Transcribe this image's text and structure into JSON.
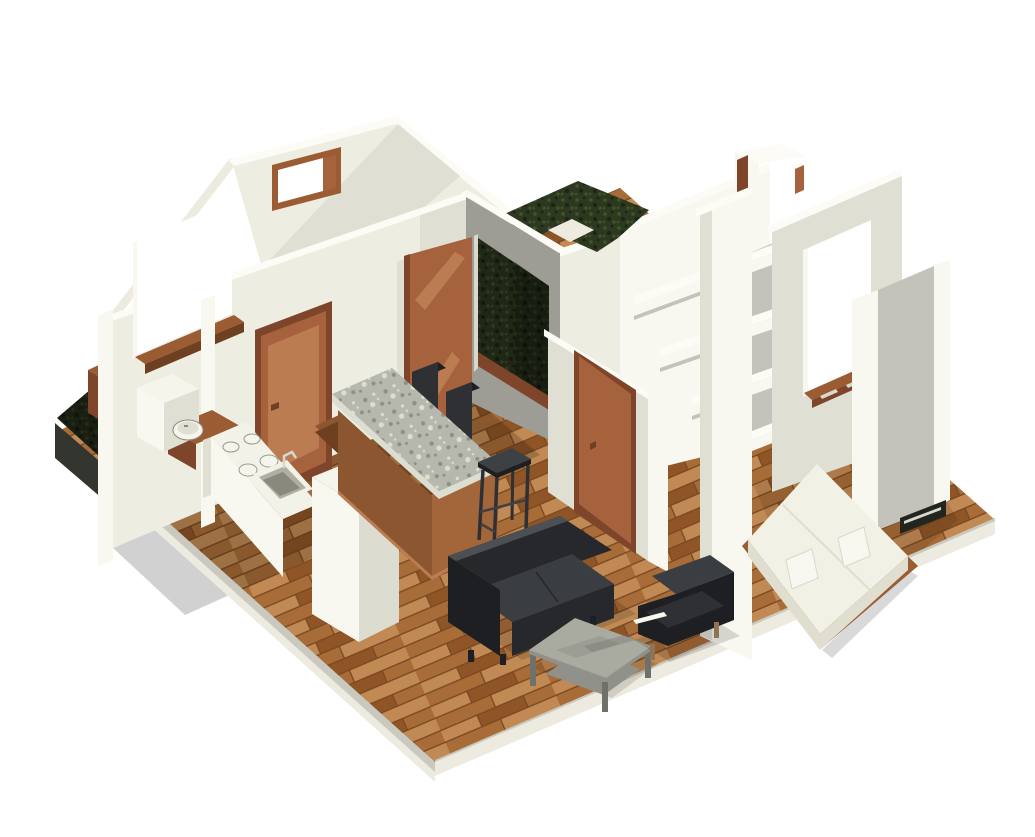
{
  "view": {
    "kind": "isometric-3d-floorplan-render"
  },
  "scene": {
    "objects": [
      "wood-floor",
      "grass-courtyard",
      "exterior-grass-strip",
      "planter-box",
      "bathroom-sink",
      "bathroom-cabinet",
      "kitchen-counter",
      "cooktop",
      "kitchen-sink",
      "refrigerator",
      "kitchen-island",
      "granite-countertop",
      "bar-stool",
      "dining-chairs",
      "interior-doors",
      "open-door",
      "windows",
      "wall-shelves",
      "sofa",
      "coffee-table",
      "armchair",
      "bed",
      "pillows",
      "bedroom-window",
      "vent"
    ]
  },
  "palette": {
    "background": "#ffffff",
    "wall_bright": "#f8f7f0",
    "wall_cream": "#eeede2",
    "wall_light": "#e0dfd4",
    "wall_mid": "#c3c3bb",
    "wall_gray": "#9d9d96",
    "cap_white": "#fcfbf6",
    "slab_side_light": "#edebdf",
    "slab_side_gray": "#c9c9c0",
    "slab_dark": "#33352f",
    "floor_base": "#b0763f",
    "floor_plank_light": "#c18a54",
    "floor_plank_mid": "#a86c38",
    "floor_plank_dark": "#8f5526",
    "floor_gap": "#7b4a22",
    "wood_trim": "#9c5c33",
    "door_face": "#a5623d",
    "door_shade": "#7e452a",
    "door_lit": "#bc7c52",
    "window_glow": "#ffffff",
    "grass_base": "#2d3820",
    "grass_light": "#44532a",
    "grass_dark": "#1b2313",
    "granite_base": "#b6b8ad",
    "granite_dark": "#8e9085",
    "granite_light": "#dcded2",
    "island_wood": "#8c5630",
    "island_wood_dark": "#6e3f20",
    "island_wood_light": "#a3663a",
    "counter_white": "#f3f2e9",
    "counter_side": "#dddcd0",
    "sink_gray": "#b0afa3",
    "sink_dark": "#8a897e",
    "fixture_white": "#f6f5ec",
    "sofa_dark": "#26282c",
    "sofa_mid": "#3a3d42",
    "sofa_light": "#4c4f54",
    "table_top": "#a9aba0",
    "table_mid": "#8f918a",
    "table_leg": "#6f716b",
    "chair_black": "#1d1f22",
    "chair_dark": "#2e3034",
    "stool_gray": "#3e4144",
    "leg_tan": "#8f7354",
    "bed_white": "#f2f1e6",
    "bed_shade": "#dfdecf",
    "bed_frame": "#9a5c33",
    "pillow_white": "#f9f8f0",
    "metal_light": "#d8d9ce",
    "vent_dark": "#23251f",
    "shadow": "#000000"
  }
}
